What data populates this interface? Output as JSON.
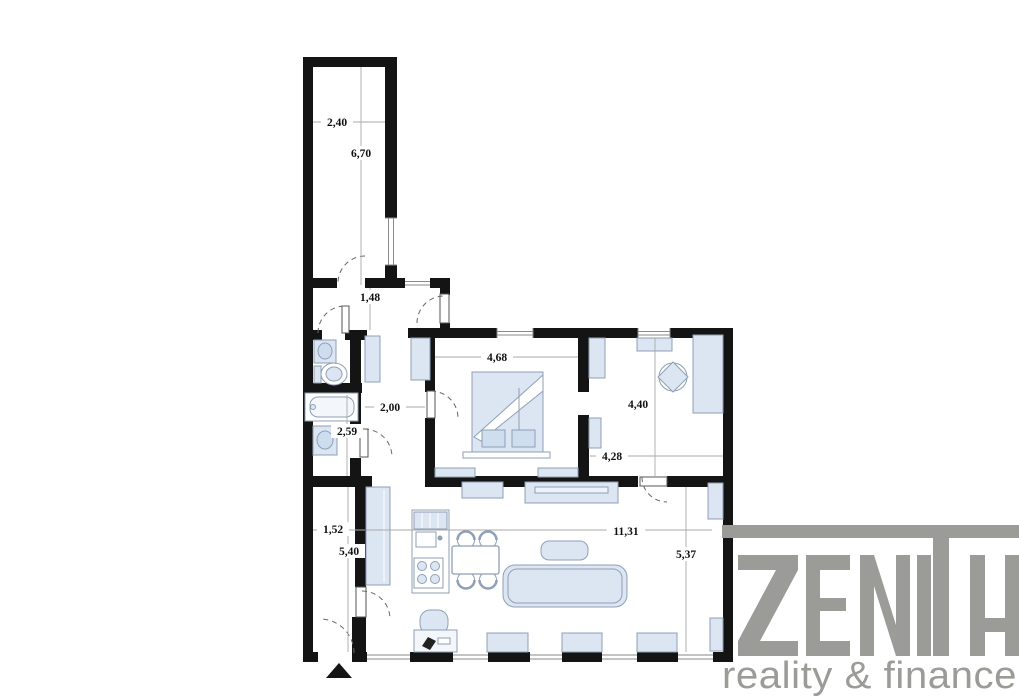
{
  "page": {
    "background": "#ffffff",
    "type": "apartment floor plan"
  },
  "colors": {
    "wall": "#141414",
    "furniture_fill": "#dce6f2",
    "furniture_stroke": "#8f9fb5",
    "dimension_line": "#aaaaaa",
    "dimension_text": "#111111",
    "logo_gray": "#9b9b97"
  },
  "floorplan": {
    "dimensions": [
      {
        "id": "corridor-width",
        "value": "2,40",
        "x": 337,
        "y": 122
      },
      {
        "id": "corridor-length",
        "value": "6,70",
        "x": 361,
        "y": 153
      },
      {
        "id": "entry-hall-depth",
        "value": "1,48",
        "x": 370,
        "y": 297
      },
      {
        "id": "hallway-width",
        "value": "2,00",
        "x": 390,
        "y": 407
      },
      {
        "id": "bathroom-length",
        "value": "2,59",
        "x": 347,
        "y": 431
      },
      {
        "id": "bedroom-width",
        "value": "4,68",
        "x": 497,
        "y": 357
      },
      {
        "id": "study-length",
        "value": "4,40",
        "x": 638,
        "y": 404
      },
      {
        "id": "study-width",
        "value": "4,28",
        "x": 612,
        "y": 456
      },
      {
        "id": "corridor2-width",
        "value": "1,52",
        "x": 333,
        "y": 529
      },
      {
        "id": "corridor2-length",
        "value": "5,40",
        "x": 349,
        "y": 551
      },
      {
        "id": "living-width",
        "value": "11,31",
        "x": 626,
        "y": 531
      },
      {
        "id": "living-length",
        "value": "5,37",
        "x": 686,
        "y": 554
      }
    ]
  },
  "logo": {
    "brand": "ZENITH",
    "subtitle": "reality & finance"
  }
}
